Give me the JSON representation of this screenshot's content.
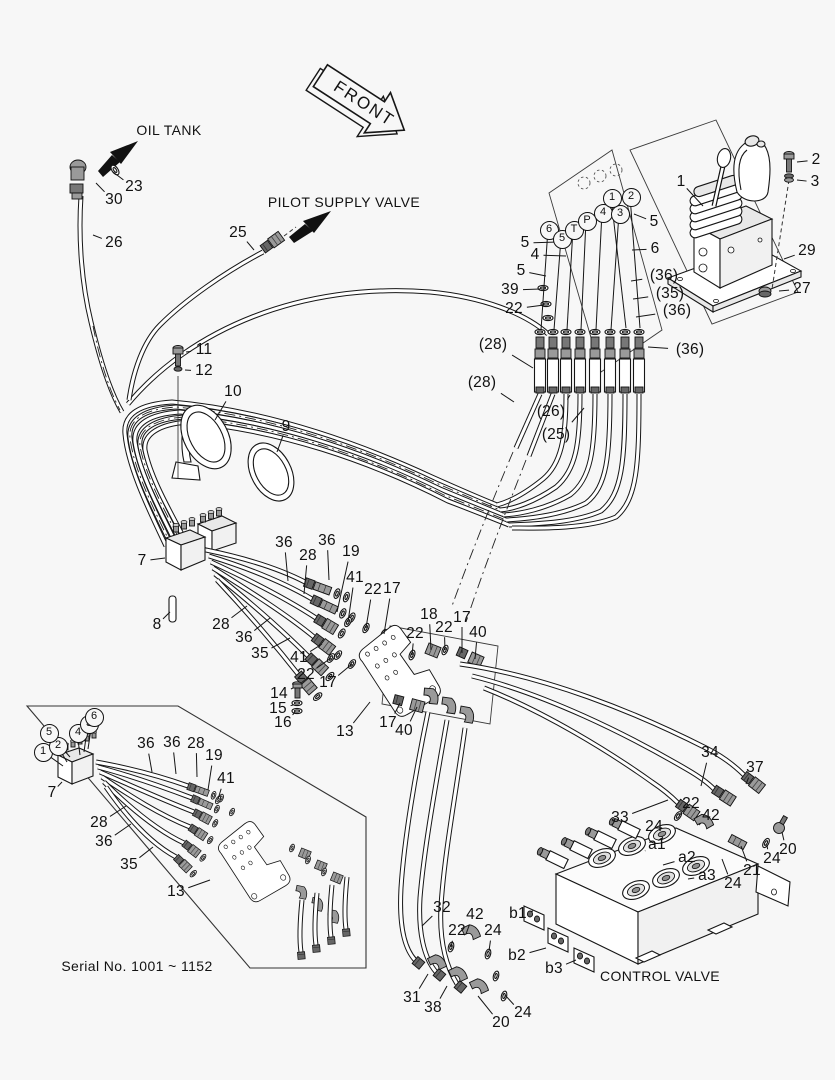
{
  "colors": {
    "background": "#f7f7f7",
    "line": "#161616"
  },
  "labels": {
    "front_arrow": "FRONT",
    "oil_tank": "OIL TANK",
    "pilot_supply_valve": "PILOT SUPPLY VALVE",
    "control_valve": "CONTROL VALVE"
  },
  "port_labels": [
    {
      "text": "6",
      "x": 548,
      "y": 229,
      "lx": 541,
      "ly": 330
    },
    {
      "text": "5",
      "x": 561,
      "y": 238,
      "lx": 554,
      "ly": 330
    },
    {
      "text": "T",
      "x": 573,
      "y": 229,
      "lx": 567,
      "ly": 330
    },
    {
      "text": "P",
      "x": 586,
      "y": 220,
      "lx": 581,
      "ly": 330
    },
    {
      "text": "4",
      "x": 602,
      "y": 212,
      "lx": 596,
      "ly": 330
    },
    {
      "text": "3",
      "x": 619,
      "y": 213,
      "lx": 611,
      "ly": 330
    },
    {
      "text": "1",
      "x": 611,
      "y": 197,
      "lx": 626,
      "ly": 328
    },
    {
      "text": "2",
      "x": 630,
      "y": 196,
      "lx": 640,
      "ly": 328
    }
  ],
  "callouts": [
    {
      "text": "1",
      "x": 681,
      "y": 182,
      "lx": 703,
      "ly": 206
    },
    {
      "text": "2",
      "x": 816,
      "y": 160,
      "lx": 797,
      "ly": 162
    },
    {
      "text": "3",
      "x": 815,
      "y": 182,
      "lx": 797,
      "ly": 180
    },
    {
      "text": "29",
      "x": 807,
      "y": 251,
      "lx": 784,
      "ly": 259
    },
    {
      "text": "27",
      "x": 802,
      "y": 289,
      "lx": 779,
      "ly": 291
    },
    {
      "text": "5",
      "x": 654,
      "y": 222,
      "lx": 634,
      "ly": 214
    },
    {
      "text": "6",
      "x": 655,
      "y": 249,
      "lx": 632,
      "ly": 250
    },
    {
      "text": "(36)",
      "x": 664,
      "y": 276,
      "lx": 631,
      "ly": 281
    },
    {
      "text": "(35)",
      "x": 670,
      "y": 294,
      "lx": 633,
      "ly": 299
    },
    {
      "text": "(36)",
      "x": 677,
      "y": 311,
      "lx": 636,
      "ly": 317
    },
    {
      "text": "5",
      "x": 525,
      "y": 243,
      "lx": 558,
      "ly": 242
    },
    {
      "text": "4",
      "x": 535,
      "y": 255,
      "lx": 566,
      "ly": 256
    },
    {
      "text": "5",
      "x": 521,
      "y": 271,
      "lx": 546,
      "ly": 276
    },
    {
      "text": "39",
      "x": 510,
      "y": 290,
      "lx": 540,
      "ly": 289
    },
    {
      "text": "22",
      "x": 514,
      "y": 309,
      "lx": 544,
      "ly": 305
    },
    {
      "text": "(28)",
      "x": 493,
      "y": 345,
      "lx": 533,
      "ly": 368
    },
    {
      "text": "(28)",
      "x": 482,
      "y": 383,
      "lx": 514,
      "ly": 402
    },
    {
      "text": "(26)",
      "x": 551,
      "y": 412,
      "lx": 570,
      "ly": 395
    },
    {
      "text": "(25)",
      "x": 556,
      "y": 435,
      "lx": 584,
      "ly": 408
    },
    {
      "text": "(36)",
      "x": 690,
      "y": 350,
      "lx": 648,
      "ly": 347
    },
    {
      "text": "23",
      "x": 134,
      "y": 187,
      "lx": 113,
      "ly": 172
    },
    {
      "text": "30",
      "x": 114,
      "y": 200,
      "lx": 96,
      "ly": 183
    },
    {
      "text": "26",
      "x": 114,
      "y": 243,
      "lx": 93,
      "ly": 235
    },
    {
      "text": "25",
      "x": 238,
      "y": 233,
      "lx": 254,
      "ly": 250
    },
    {
      "text": "11",
      "x": 204,
      "y": 350,
      "lx": 186,
      "ly": 352
    },
    {
      "text": "12",
      "x": 204,
      "y": 371,
      "lx": 185,
      "ly": 370
    },
    {
      "text": "10",
      "x": 233,
      "y": 392,
      "lx": 215,
      "ly": 420
    },
    {
      "text": "9",
      "x": 286,
      "y": 427,
      "lx": 277,
      "ly": 452
    },
    {
      "text": "7",
      "x": 142,
      "y": 561,
      "lx": 165,
      "ly": 558
    },
    {
      "text": "8",
      "x": 157,
      "y": 625,
      "lx": 170,
      "ly": 612
    },
    {
      "text": "36",
      "x": 284,
      "y": 543,
      "lx": 288,
      "ly": 581
    },
    {
      "text": "28",
      "x": 308,
      "y": 556,
      "lx": 304,
      "ly": 594
    },
    {
      "text": "36",
      "x": 327,
      "y": 541,
      "lx": 329,
      "ly": 580
    },
    {
      "text": "19",
      "x": 351,
      "y": 552,
      "lx": 337,
      "ly": 612
    },
    {
      "text": "41",
      "x": 355,
      "y": 578,
      "lx": 348,
      "ly": 622
    },
    {
      "text": "22",
      "x": 373,
      "y": 590,
      "lx": 366,
      "ly": 628
    },
    {
      "text": "17",
      "x": 392,
      "y": 589,
      "lx": 384,
      "ly": 634
    },
    {
      "text": "28",
      "x": 221,
      "y": 625,
      "lx": 247,
      "ly": 606
    },
    {
      "text": "36",
      "x": 244,
      "y": 638,
      "lx": 270,
      "ly": 618
    },
    {
      "text": "35",
      "x": 260,
      "y": 654,
      "lx": 290,
      "ly": 638
    },
    {
      "text": "41",
      "x": 299,
      "y": 658,
      "lx": 322,
      "ly": 644
    },
    {
      "text": "22",
      "x": 306,
      "y": 675,
      "lx": 331,
      "ly": 658
    },
    {
      "text": "17",
      "x": 328,
      "y": 683,
      "lx": 352,
      "ly": 664
    },
    {
      "text": "14",
      "x": 279,
      "y": 694,
      "lx": 293,
      "ly": 688
    },
    {
      "text": "15",
      "x": 278,
      "y": 709,
      "lx": 293,
      "ly": 705
    },
    {
      "text": "16",
      "x": 283,
      "y": 723,
      "lx": 295,
      "ly": 712
    },
    {
      "text": "13",
      "x": 345,
      "y": 732,
      "lx": 370,
      "ly": 702
    },
    {
      "text": "18",
      "x": 429,
      "y": 615,
      "lx": 431,
      "ly": 650
    },
    {
      "text": "22",
      "x": 444,
      "y": 628,
      "lx": 445,
      "ly": 650
    },
    {
      "text": "17",
      "x": 462,
      "y": 618,
      "lx": 462,
      "ly": 653
    },
    {
      "text": "40",
      "x": 478,
      "y": 633,
      "lx": 475,
      "ly": 659
    },
    {
      "text": "22",
      "x": 415,
      "y": 634,
      "lx": 412,
      "ly": 655
    },
    {
      "text": "17",
      "x": 388,
      "y": 723,
      "lx": 400,
      "ly": 703
    },
    {
      "text": "40",
      "x": 404,
      "y": 731,
      "lx": 417,
      "ly": 707
    },
    {
      "text": "34",
      "x": 710,
      "y": 753,
      "lx": 701,
      "ly": 786
    },
    {
      "text": "37",
      "x": 755,
      "y": 768,
      "lx": 746,
      "ly": 784
    },
    {
      "text": "33",
      "x": 620,
      "y": 818,
      "lx": 668,
      "ly": 800
    },
    {
      "text": "22",
      "x": 691,
      "y": 804,
      "lx": 679,
      "ly": 816
    },
    {
      "text": "42",
      "x": 711,
      "y": 816,
      "lx": 699,
      "ly": 825
    },
    {
      "text": "24",
      "x": 654,
      "y": 827,
      "lx": 663,
      "ly": 839
    },
    {
      "text": "a1",
      "x": 657,
      "y": 845,
      "lx": 645,
      "ly": 851
    },
    {
      "text": "a2",
      "x": 687,
      "y": 858,
      "lx": 663,
      "ly": 865
    },
    {
      "text": "a3",
      "x": 707,
      "y": 876,
      "lx": 688,
      "ly": 879
    },
    {
      "text": "24",
      "x": 733,
      "y": 884,
      "lx": 722,
      "ly": 859
    },
    {
      "text": "21",
      "x": 752,
      "y": 871,
      "lx": 741,
      "ly": 846
    },
    {
      "text": "24",
      "x": 772,
      "y": 859,
      "lx": 767,
      "ly": 845
    },
    {
      "text": "20",
      "x": 788,
      "y": 850,
      "lx": 782,
      "ly": 832
    },
    {
      "text": "32",
      "x": 442,
      "y": 908,
      "lx": 422,
      "ly": 926
    },
    {
      "text": "42",
      "x": 475,
      "y": 915,
      "lx": 466,
      "ly": 934
    },
    {
      "text": "22",
      "x": 457,
      "y": 931,
      "lx": 451,
      "ly": 947
    },
    {
      "text": "24",
      "x": 493,
      "y": 931,
      "lx": 489,
      "ly": 951
    },
    {
      "text": "b1",
      "x": 518,
      "y": 914,
      "lx": 533,
      "ly": 911
    },
    {
      "text": "b2",
      "x": 517,
      "y": 956,
      "lx": 546,
      "ly": 948
    },
    {
      "text": "b3",
      "x": 554,
      "y": 969,
      "lx": 576,
      "ly": 960
    },
    {
      "text": "31",
      "x": 412,
      "y": 998,
      "lx": 428,
      "ly": 974
    },
    {
      "text": "38",
      "x": 433,
      "y": 1008,
      "lx": 447,
      "ly": 986
    },
    {
      "text": "20",
      "x": 501,
      "y": 1023,
      "lx": 478,
      "ly": 996
    },
    {
      "text": "24",
      "x": 523,
      "y": 1013,
      "lx": 505,
      "ly": 995
    }
  ],
  "inset": {
    "serial_note": "Serial No. 1001 ~ 1152",
    "port_labels": [
      {
        "text": "1",
        "x": 42,
        "y": 751,
        "lx": 63,
        "ly": 766
      },
      {
        "text": "2",
        "x": 57,
        "y": 745,
        "lx": 67,
        "ly": 762
      },
      {
        "text": "5",
        "x": 48,
        "y": 732,
        "lx": 70,
        "ly": 757
      },
      {
        "text": "4",
        "x": 77,
        "y": 732,
        "lx": 80,
        "ly": 755
      },
      {
        "text": "3",
        "x": 88,
        "y": 723,
        "lx": 84,
        "ly": 752
      },
      {
        "text": "6",
        "x": 93,
        "y": 716,
        "lx": 88,
        "ly": 749
      }
    ],
    "callouts": [
      {
        "text": "7",
        "x": 52,
        "y": 793,
        "lx": 62,
        "ly": 782
      },
      {
        "text": "36",
        "x": 146,
        "y": 744,
        "lx": 152,
        "ly": 772
      },
      {
        "text": "36",
        "x": 172,
        "y": 743,
        "lx": 176,
        "ly": 774
      },
      {
        "text": "28",
        "x": 196,
        "y": 744,
        "lx": 197,
        "ly": 777
      },
      {
        "text": "19",
        "x": 214,
        "y": 756,
        "lx": 208,
        "ly": 790
      },
      {
        "text": "41",
        "x": 226,
        "y": 779,
        "lx": 218,
        "ly": 799
      },
      {
        "text": "28",
        "x": 99,
        "y": 823,
        "lx": 126,
        "ly": 806
      },
      {
        "text": "36",
        "x": 104,
        "y": 842,
        "lx": 131,
        "ly": 824
      },
      {
        "text": "35",
        "x": 129,
        "y": 865,
        "lx": 153,
        "ly": 847
      },
      {
        "text": "13",
        "x": 176,
        "y": 892,
        "lx": 210,
        "ly": 880
      }
    ]
  }
}
